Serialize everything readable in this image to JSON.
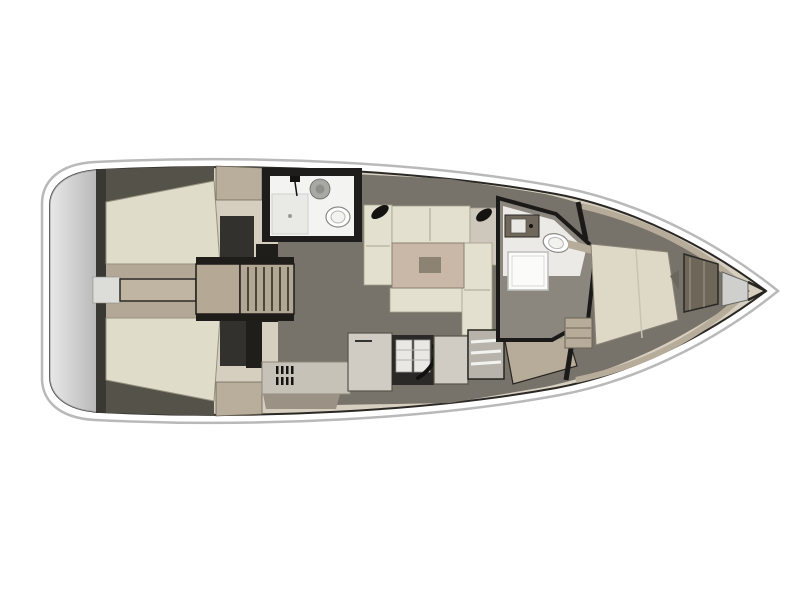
{
  "canvas": {
    "background": "#ffffff"
  },
  "colors": {
    "hullFill": "#ffffff",
    "hullStroke": "#b9b9b9",
    "innerLine": "#2a2824",
    "deckBand": "#d6cfc0",
    "transomLight": "#e8e8e8",
    "transomDark": "#b5b5b5",
    "transomTrim": "#3a3833",
    "passageGray": "#dcdcd8",
    "cockpitFloor": "#b3a896",
    "benchCream": "#dfdcca",
    "benchStroke": "#97927f",
    "coamingDark": "#55524a",
    "helmSeat": "#b9ae9b",
    "consoleDark": "#33312d",
    "walkwayTan": "#c0b5a2",
    "tableTan": "#b5a996",
    "frameBlack": "#1e1d1a",
    "stepsTan": "#b2a795",
    "slatDark": "#4a4638",
    "bulkheadBlack": "#201e1b",
    "soleTaupe": "#78736a",
    "cushionCream": "#e3e0cf",
    "cushionGray": "#cdc8bb",
    "cushionStroke": "#a39e8a",
    "tablePink": "#c9b8a7",
    "tableInset": "#8d8373",
    "bathFrame": "#1f1d1b",
    "bathWhite": "#f3f3f1",
    "showerGray": "#e9e9e6",
    "fixtureGray": "#a8a8a5",
    "toiletWhite": "#ffffff",
    "fixtureStroke": "#8a8a86",
    "galleyCounter": "#c6c2b8",
    "galleyLockers": "#9b9184",
    "galleyUnit": "#d0ccc4",
    "galleySinkDark": "#2a2927",
    "rackWhite": "#e9e8e4",
    "stoveGray": "#b7b3ab",
    "stripeWhite": "#f2f2ef",
    "navTan": "#b7ab99",
    "doorWhite": "#f0efeb",
    "headFloor": "#8c877e",
    "headWhite": "#eceae6",
    "showerWhite": "#fbfbfa",
    "sinkCabinet": "#6f675c",
    "bedCream": "#ddd9c6",
    "bedStroke": "#8a8476",
    "trimTan": "#b7ac9a",
    "wardrobe": "#6e6659",
    "lockerGray": "#cfcfcd",
    "detailBlack": "#141311"
  }
}
